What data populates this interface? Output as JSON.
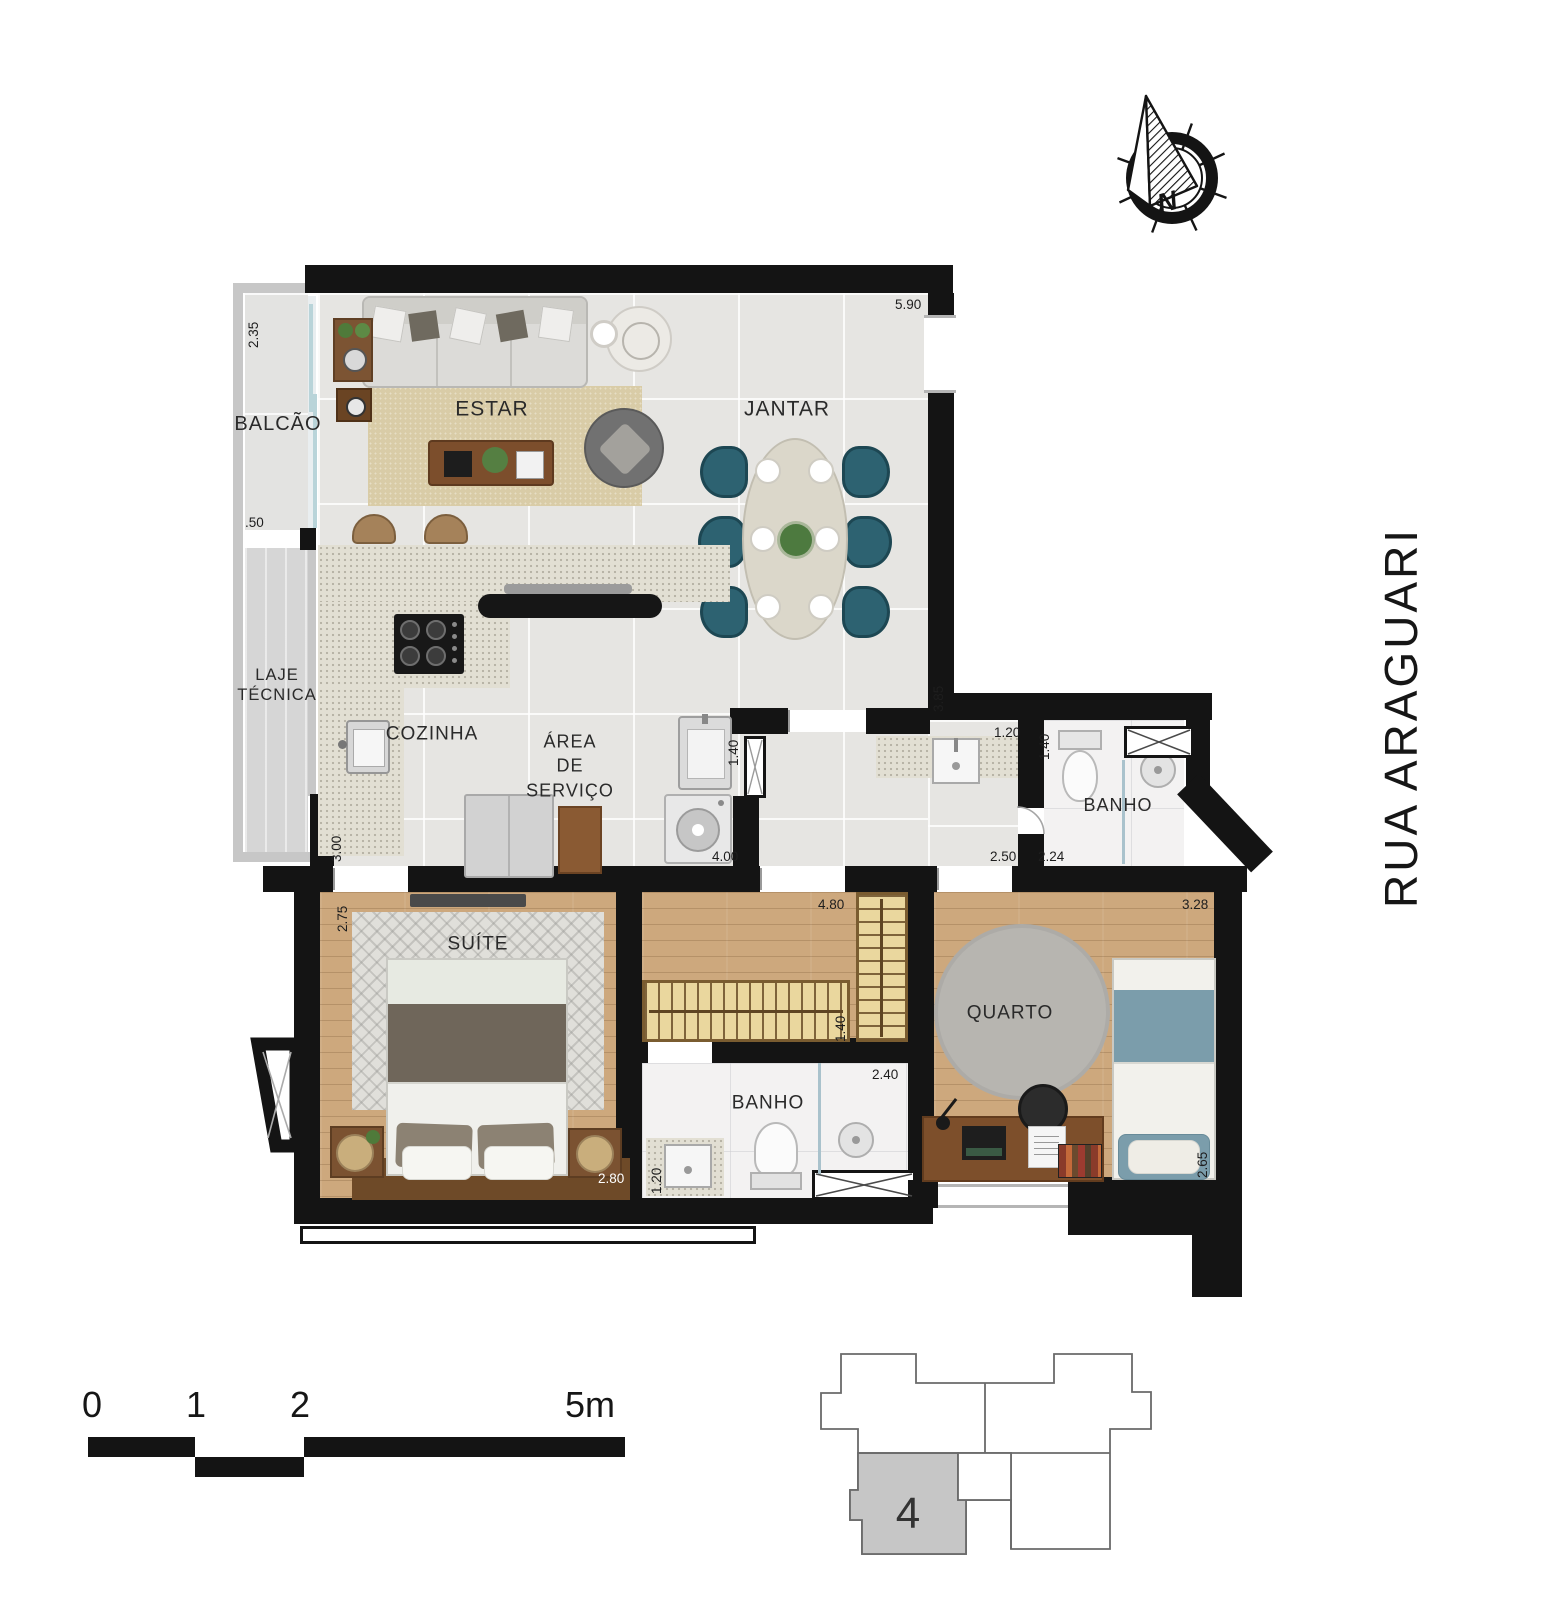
{
  "rooms": {
    "balcao": "BALCÃO",
    "laje_line1": "LAJE",
    "laje_line2": "TÉCNICA",
    "estar": "ESTAR",
    "jantar": "JANTAR",
    "cozinha": "COZINHA",
    "servico_line1": "ÁREA",
    "servico_line2": "DE",
    "servico_line3": "SERVIÇO",
    "banho_social": "BANHO",
    "suite": "SUÍTE",
    "banho_suite": "BANHO",
    "quarto": "QUARTO"
  },
  "dims": {
    "balcony_depth": "2.35",
    "balcony_opening": ".50",
    "living_width": "5.90",
    "living_depth": "3.85",
    "kitchen_depth": "3.00",
    "service_width": "4.00",
    "service_sink_width": "1.40",
    "corridor_sink_width": "1.20",
    "banho_social_width": "1.40",
    "corridor_width": "2.50",
    "banho_social_length": "2.24",
    "quarto_width": "3.28",
    "quarto_depth": "2.65",
    "hall_length": "4.80",
    "closet_depth": "1.40",
    "banho_suite_length": "2.40",
    "banho_suite_width": "1.20",
    "suite_width": "2.80",
    "suite_depth": "2.75"
  },
  "street": {
    "name": "RUA ARAGUARI"
  },
  "compass": {
    "north_letter": "N"
  },
  "scale_bar": {
    "tick_0": "0",
    "tick_1": "1",
    "tick_2": "2",
    "tick_5": "5m"
  },
  "key_plan": {
    "unit_number": "4"
  }
}
